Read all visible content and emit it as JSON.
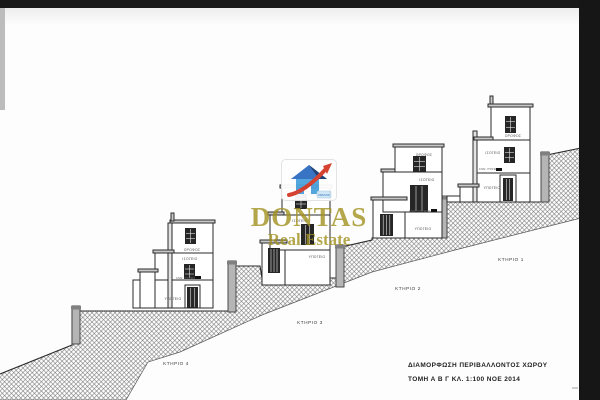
{
  "canvas": {
    "paper_color": "#fdfdfd",
    "frame_color": "#191919",
    "left_strip_color": "#bcbcbc",
    "hatch_color": "#6f6f6f",
    "line_color": "#2b2b2b"
  },
  "titleblock": {
    "line1": "ΔΙΑΜΟΡΦΩΣΗ ΠΕΡΙΒΑΛΛΟΝΤΟΣ ΧΩΡΟΥ",
    "line2": "ΤΟΜΗ Α Β Γ   ΚΛ. 1:100   ΝΟΕ 2014"
  },
  "logo": {
    "name": "DONTAS",
    "subtitle": "Real Estate",
    "tag": "ΟΜΙΛΟΣ",
    "text_color": "#a29220",
    "house_blue": "#4aa3dd",
    "roof_blue": "#2f6cc0",
    "roof_dark_blue": "#16386e",
    "arrow_red": "#d43826"
  },
  "terrain": {
    "outline": [
      [
        0,
        374
      ],
      [
        72,
        345
      ],
      [
        72,
        311
      ],
      [
        229,
        311
      ],
      [
        229,
        266
      ],
      [
        260,
        266
      ],
      [
        262,
        278
      ],
      [
        337,
        278
      ],
      [
        337,
        248
      ],
      [
        372,
        240
      ],
      [
        372,
        238
      ],
      [
        440,
        238
      ],
      [
        440,
        200
      ],
      [
        455,
        202
      ],
      [
        542,
        202
      ],
      [
        542,
        156
      ],
      [
        581,
        148
      ],
      [
        581,
        218
      ],
      [
        455,
        250
      ],
      [
        372,
        272
      ],
      [
        262,
        315
      ],
      [
        180,
        352
      ],
      [
        148,
        362
      ],
      [
        126,
        400
      ],
      [
        0,
        400
      ]
    ],
    "surface_end_index": 16
  },
  "retaining_walls": [
    [
      72,
      306,
      8,
      38
    ],
    [
      228,
      261,
      8,
      51
    ],
    [
      336,
      245,
      8,
      42
    ],
    [
      439,
      196,
      8,
      42
    ],
    [
      541,
      152,
      8,
      50
    ]
  ],
  "tick_mark": [
    572,
    388,
    578,
    388
  ],
  "buildings": [
    {
      "id": "building-1",
      "label": "ΚΤΗΡΙΟ 1",
      "label_pos": [
        511,
        261
      ],
      "boxes": [
        [
          447,
          196,
          13,
          6
        ],
        [
          460,
          187,
          17,
          15
        ],
        [
          477,
          173,
          53,
          29
        ],
        [
          477,
          140,
          53,
          33
        ],
        [
          491,
          107,
          39,
          33
        ]
      ],
      "thin_walls": [
        [
          473,
          131,
          4,
          71
        ]
      ],
      "slabs": [
        [
          488,
          104,
          45,
          3
        ],
        [
          474,
          137,
          19,
          3
        ],
        [
          458,
          184,
          21,
          3
        ],
        [
          490,
          96,
          3,
          8
        ]
      ],
      "openings": [
        {
          "type": "window",
          "rect": [
            505,
            116,
            11,
            17
          ]
        },
        {
          "type": "window",
          "rect": [
            504,
            147,
            11,
            16
          ]
        },
        {
          "type": "door",
          "rect": [
            503,
            178,
            10,
            23
          ],
          "frame": [
            500,
            175,
            16,
            27
          ]
        }
      ],
      "floor_labels": [
        {
          "text": "ΟΡΟΦΟΣ",
          "x": 513,
          "y": 137
        },
        {
          "text": "ΙΣΟΓΕΙΟ",
          "x": 493,
          "y": 154
        },
        {
          "text": "ΥΠΟΓΕΙΟ",
          "x": 492,
          "y": 189
        }
      ],
      "annotation": {
        "text": "ΚΛΙΜ. ΥΠΟΓΕΙΟΥ",
        "x": 479,
        "y": 170,
        "marker": [
          496,
          168,
          6,
          3
        ]
      }
    },
    {
      "id": "building-2",
      "label": "ΚΤΗΡΙΟ 2",
      "label_pos": [
        408,
        290
      ],
      "boxes": [
        [
          373,
          200,
          32,
          38
        ],
        [
          383,
          172,
          59,
          40
        ],
        [
          405,
          212,
          37,
          26
        ],
        [
          395,
          147,
          47,
          25
        ]
      ],
      "thin_walls": [],
      "slabs": [
        [
          371,
          197,
          36,
          3
        ],
        [
          393,
          144,
          51,
          3
        ],
        [
          381,
          169,
          14,
          3
        ]
      ],
      "openings": [
        {
          "type": "window",
          "rect": [
            413,
            156,
            13,
            16
          ]
        },
        {
          "type": "door",
          "rect": [
            410,
            185,
            18,
            27
          ]
        },
        {
          "type": "shutter",
          "rect": [
            380,
            214,
            13,
            22
          ]
        }
      ],
      "floor_labels": [
        {
          "text": "ΟΡΟΦΟΣ",
          "x": 424,
          "y": 156
        },
        {
          "text": "ΙΣΟΓΕΙΟ",
          "x": 427,
          "y": 181
        },
        {
          "text": "ΥΠΟΓΕΙΟ",
          "x": 423,
          "y": 230
        }
      ],
      "annotation": {
        "text": "ΚΛΙΜ. ΥΠΟΓΕΙΟΥ",
        "x": 409,
        "y": 212,
        "marker": [
          431,
          209,
          6,
          3
        ]
      }
    },
    {
      "id": "building-3",
      "label": "ΚΤΗΡΙΟ 3",
      "label_pos": [
        310,
        324
      ],
      "boxes": [
        [
          262,
          243,
          23,
          42
        ],
        [
          270,
          215,
          60,
          35
        ],
        [
          285,
          250,
          45,
          35
        ],
        [
          282,
          188,
          48,
          27
        ]
      ],
      "thin_walls": [],
      "slabs": [
        [
          260,
          240,
          27,
          3
        ],
        [
          280,
          185,
          52,
          3
        ],
        [
          268,
          212,
          16,
          3
        ]
      ],
      "openings": [
        {
          "type": "window",
          "rect": [
            295,
            194,
            12,
            15
          ]
        },
        {
          "type": "door",
          "rect": [
            301,
            224,
            13,
            21
          ]
        },
        {
          "type": "shutter",
          "rect": [
            268,
            248,
            12,
            25
          ]
        }
      ],
      "floor_labels": [
        {
          "text": "ΟΡΟΦΟΣ",
          "x": 315,
          "y": 196
        },
        {
          "text": "ΙΣΟΓΕΙΟ",
          "x": 300,
          "y": 222
        },
        {
          "text": "ΥΠΟΓΕΙΟ",
          "x": 317,
          "y": 258
        }
      ],
      "annotation": null
    },
    {
      "id": "building-4",
      "label": "ΚΤΗΡΙΟ 4",
      "label_pos": [
        176,
        365
      ],
      "boxes": [
        [
          133,
          280,
          8,
          28
        ],
        [
          140,
          272,
          16,
          36
        ],
        [
          155,
          253,
          58,
          27
        ],
        [
          155,
          280,
          58,
          28
        ],
        [
          172,
          223,
          41,
          30
        ]
      ],
      "thin_walls": [
        [
          168,
          223,
          4,
          85
        ]
      ],
      "slabs": [
        [
          138,
          269,
          20,
          3
        ],
        [
          170,
          220,
          45,
          3
        ],
        [
          153,
          250,
          21,
          3
        ],
        [
          171,
          213,
          3,
          8
        ]
      ],
      "openings": [
        {
          "type": "window",
          "rect": [
            185,
            228,
            11,
            16
          ]
        },
        {
          "type": "window",
          "rect": [
            184,
            264,
            11,
            15
          ]
        },
        {
          "type": "door",
          "rect": [
            187,
            287,
            11,
            21
          ],
          "frame": [
            185,
            285,
            15,
            23
          ]
        }
      ],
      "floor_labels": [
        {
          "text": "ΟΡΟΦΟΣ",
          "x": 192,
          "y": 251
        },
        {
          "text": "ΙΣΟΓΕΙΟ",
          "x": 190,
          "y": 260
        },
        {
          "text": "ΥΠΟΓΕΙΟ",
          "x": 173,
          "y": 300
        }
      ],
      "annotation": {
        "text": "ΚΛΙΜ. ΥΠΟΓΕΙΟΥ",
        "x": 176,
        "y": 279,
        "marker": [
          195,
          276,
          6,
          3
        ]
      }
    }
  ]
}
